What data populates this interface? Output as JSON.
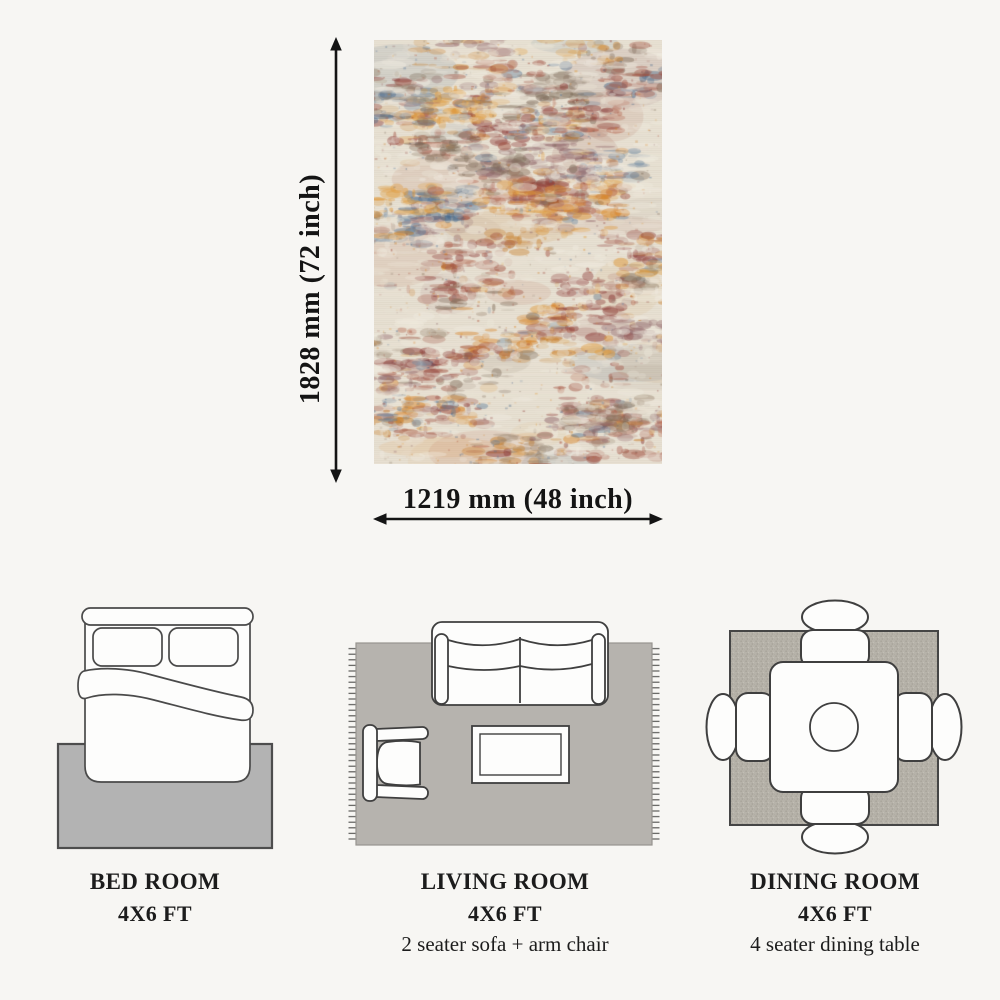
{
  "diagram": {
    "height_label": "1828 mm (72 inch)",
    "width_label": "1219 mm (48 inch)",
    "arrow_color": "#141414",
    "rug_palette": {
      "base": "#e9e2d4",
      "light": "#f1ece1",
      "accents": [
        "#a04e3e",
        "#8c3a36",
        "#b4614a",
        "#d8862c",
        "#c77a22",
        "#e09a3a",
        "#47678a",
        "#5d7c9b",
        "#96826c",
        "#7d6a58",
        "#90666a",
        "#f0ebe0"
      ]
    }
  },
  "rooms": [
    {
      "title": "BED ROOM",
      "size": "4X6 FT",
      "note": ""
    },
    {
      "title": "LIVING ROOM",
      "size": "4X6 FT",
      "note": "2 seater sofa + arm chair"
    },
    {
      "title": "DINING ROOM",
      "size": "4X6 FT",
      "note": "4 seater dining table"
    }
  ]
}
